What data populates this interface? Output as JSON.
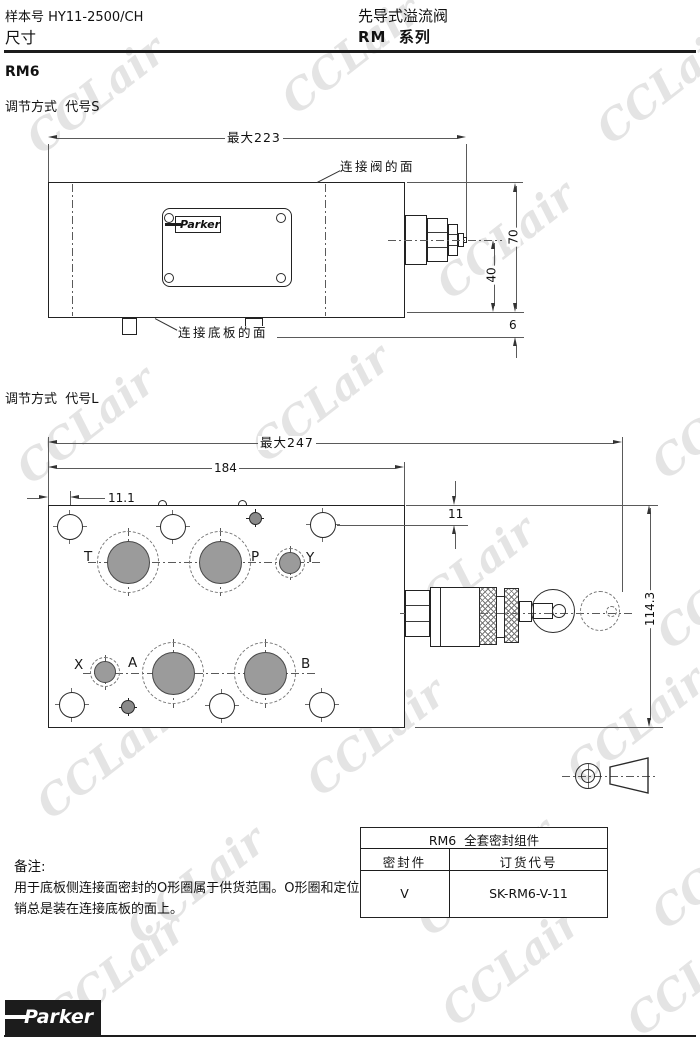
{
  "watermark": {
    "text": "CCLair",
    "color": "#e4e4e4"
  },
  "colors": {
    "line": "#222222",
    "port_fill": "#9b9b9b",
    "logo_bg": "#1c1c1c"
  },
  "header": {
    "doc_no": "样本号 HY11-2500/CH",
    "dim_label": "尺寸",
    "title": "先导式溢流阀",
    "series": "RM  系列"
  },
  "model_label": "RM6",
  "drawing1": {
    "caption": "调节方式  代号S",
    "dims": {
      "max_width": "最大223",
      "height": "70",
      "center_height": "40",
      "pin_height": "6"
    },
    "labels": {
      "valve_face": "连接阀的面",
      "plate_face": "连接底板的面"
    },
    "nameplate_logo": "Parker"
  },
  "drawing2": {
    "caption": "调节方式  代号L",
    "dims": {
      "max_width": "最大247",
      "body_width": "184",
      "hole_offset": "11.1",
      "hole_top": "11",
      "total_height": "114.3"
    },
    "ports": {
      "t": "T",
      "p": "P",
      "y": "Y",
      "x": "X",
      "a": "A",
      "b": "B"
    }
  },
  "seal_table": {
    "title": "RM6  全套密封组件",
    "col_seal": "密封件",
    "col_code": "订货代号",
    "seal": "V",
    "code": "SK-RM6-V-11"
  },
  "notes": {
    "heading": "备注:",
    "line1": "用于底板侧连接面密封的O形圈属于供货范围。O形圈和定位",
    "line2": "销总是装在连接底板的面上。"
  },
  "footer": {
    "logo": "Parker"
  }
}
